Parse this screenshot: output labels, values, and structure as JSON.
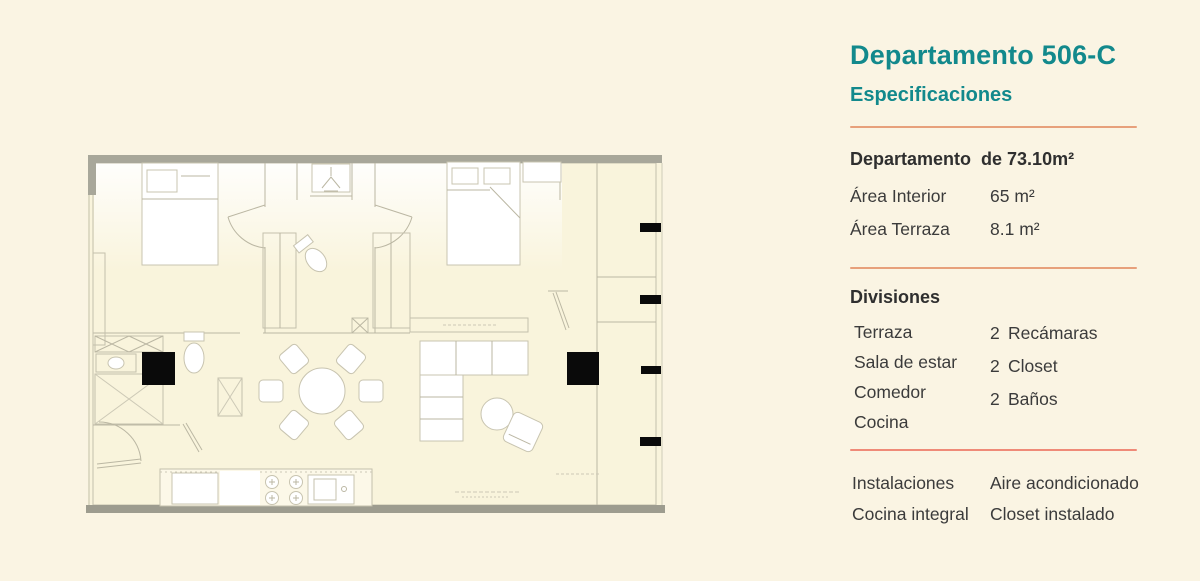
{
  "theme": {
    "background": "#FAF4E3",
    "panel_text": "#3B3B3B",
    "heading_teal": "#12898C",
    "divider_orange": "#E7A07B",
    "divider_red": "#EF8A78",
    "plan_background": "#F9F4DC",
    "wall_gray": "#A5A497",
    "line_color": "#BBB7A3",
    "column_black": "#0A0A0A"
  },
  "panel": {
    "title": "Departamento 506-C",
    "subtitle": "Especificaciones",
    "summary": {
      "label": "Departamento",
      "value": "de 73.10m²"
    },
    "areas": [
      {
        "label": "Área Interior",
        "value": "65 m²"
      },
      {
        "label": "Área Terraza",
        "value": "8.1 m²"
      }
    ],
    "divisiones": {
      "heading": "Divisiones",
      "left": [
        "Terraza",
        "Sala de estar",
        "Comedor",
        "Cocina"
      ],
      "right": [
        {
          "count": "2",
          "label": "Recámaras"
        },
        {
          "count": "2",
          "label": "Closet"
        },
        {
          "count": "2",
          "label": "Baños"
        }
      ]
    },
    "instalaciones": {
      "rows": [
        {
          "left": "Instalaciones",
          "right": "Aire acondicionado"
        },
        {
          "left": "Cocina integral",
          "right": "Closet instalado"
        }
      ]
    }
  }
}
